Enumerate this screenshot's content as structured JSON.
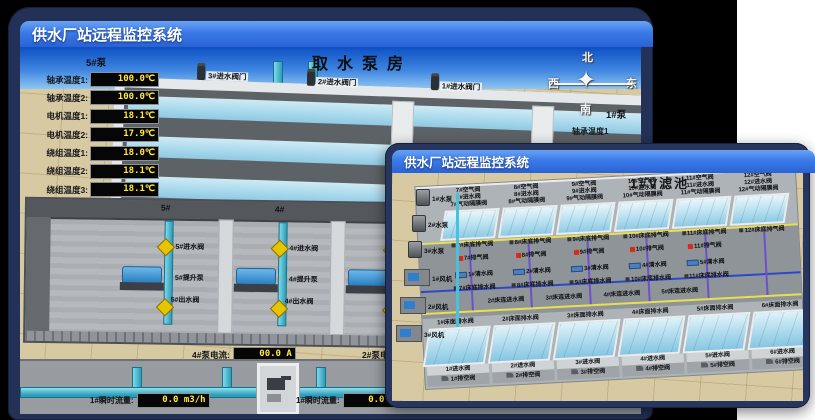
{
  "colors": {
    "titlebar_blue": "#2f6de0",
    "frame_navy": "#233156",
    "led_yellow": "#ffe93c",
    "ground_beige": "#d7c9a2",
    "water_blue": "#9fd3e8",
    "pipe_cyan": "#2d9cb8",
    "valve_yellow": "#e6c500",
    "alarm_red": "#d92a18"
  },
  "back_window": {
    "title": "供水厂站远程监控系统",
    "scene_title": "取水泵房",
    "sensor_panel": {
      "header": "5#泵",
      "rows": [
        {
          "label": "轴承温度1:",
          "value": "100.0℃"
        },
        {
          "label": "轴承温度2:",
          "value": "100.0℃"
        },
        {
          "label": "电机温度1:",
          "value": "18.1℃"
        },
        {
          "label": "电机温度2:",
          "value": "17.9℃"
        },
        {
          "label": "绕组温度1:",
          "value": "18.0℃"
        },
        {
          "label": "绕组温度2:",
          "value": "18.1℃"
        },
        {
          "label": "绕组温度3:",
          "value": "18.1℃"
        },
        {
          "label": "管道压力:",
          "value": "0.0007MPa"
        },
        {
          "label": "多功能阀:",
          "value": "0%"
        }
      ]
    },
    "inlet_valves": [
      "3#进水阀门",
      "2#进水阀门",
      "1#进水阀门"
    ],
    "compass": {
      "north": "北",
      "west": "西",
      "south": "南",
      "east": "东",
      "star": "✦"
    },
    "right_panel": {
      "header": "1#泵",
      "rows": [
        "轴承温度1",
        "轴承温度2"
      ]
    },
    "pump_bays": [
      {
        "no": "5#",
        "inlet": "5#进水阀",
        "pump": "5#提升泵",
        "outlet": "5#出水阀"
      },
      {
        "no": "4#",
        "inlet": "4#进水阀",
        "pump": "4#提升泵",
        "outlet": "4#出水阀"
      },
      {
        "no": "3#",
        "inlet": "3#进水阀",
        "pump": "3#提升泵",
        "outlet": "3#出水阀"
      },
      {
        "no": "2#",
        "inlet": "2#进水阀",
        "pump": "2#提升泵",
        "outlet": "2#出水阀"
      }
    ],
    "current_readouts": [
      {
        "label": "4#泵电流:",
        "value": "00.0 A"
      },
      {
        "label": "2#泵电流:",
        "value": "00.0 A"
      }
    ],
    "flow_readouts": [
      {
        "label": "1#瞬时流量:",
        "value": "0.0 m3/h"
      },
      {
        "label": "1#瞬时流量:",
        "value": "0.0 m3/h"
      }
    ]
  },
  "front_window": {
    "title": "供水厂站远程监控系统",
    "scene_title": "1#V滤池",
    "equipment_pumps": [
      "1#水泵",
      "2#水泵",
      "3#水泵"
    ],
    "equipment_fans": [
      "1#风机",
      "2#风机",
      "3#风机"
    ],
    "top_pools": [
      {
        "air": "7#空气阀",
        "inlet": "7#进水阀",
        "diaphragm": "7#气动隔膜阀"
      },
      {
        "air": "8#空气阀",
        "inlet": "8#进水阀",
        "diaphragm": "8#气动隔膜阀"
      },
      {
        "air": "9#空气阀",
        "inlet": "9#进水阀",
        "diaphragm": "9#气动隔膜阀"
      },
      {
        "air": "10#空气阀",
        "inlet": "10#进水阀",
        "diaphragm": "10#气动隔膜阀"
      },
      {
        "air": "11#空气阀",
        "inlet": "11#进水阀",
        "diaphragm": "11#气动隔膜阀"
      },
      {
        "air": "12#空气阀",
        "inlet": "12#进水阀",
        "diaphragm": "12#气动隔膜阀"
      }
    ],
    "mid_rows": {
      "bed_air_release": [
        "7#床底排气阀",
        "8#床底排气阀",
        "9#床底排气阀",
        "10#床底排气阀",
        "11#床底排气阀",
        "12#床底排气阀"
      ],
      "air_release": [
        "7#排气阀",
        "8#排气阀",
        "9#排气阀",
        "10#排气阀",
        "11#排气阀"
      ],
      "clean_water": [
        "1#清水阀",
        "2#清水阀",
        "3#清水阀",
        "4#清水阀",
        "5#清水阀"
      ],
      "bed_drain": [
        "7#床底排水阀",
        "8#床底排水阀",
        "9#床底排水阀",
        "10#床底排水阀",
        "11#床底排水阀"
      ],
      "bed_inlet": [
        "2#床连进水阀",
        "3#床连进水阀",
        "4#床连进水阀",
        "5#床连进水阀"
      ]
    },
    "bottom_pools": [
      {
        "surface_drain": "1#床面排水阀",
        "inlet": "1#进水阀",
        "vent": "1#排空阀"
      },
      {
        "surface_drain": "2#床面排水阀",
        "inlet": "2#进水阀",
        "vent": "2#排空阀"
      },
      {
        "surface_drain": "3#床面排水阀",
        "inlet": "3#进水阀",
        "vent": "3#排空阀"
      },
      {
        "surface_drain": "4#床面排水阀",
        "inlet": "4#进水阀",
        "vent": "4#排空阀"
      },
      {
        "surface_drain": "5#床面排水阀",
        "inlet": "5#进水阀",
        "vent": "5#排空阀"
      },
      {
        "surface_drain": "6#床面排水阀",
        "inlet": "6#进水阀",
        "vent": "6#排空阀"
      }
    ]
  }
}
